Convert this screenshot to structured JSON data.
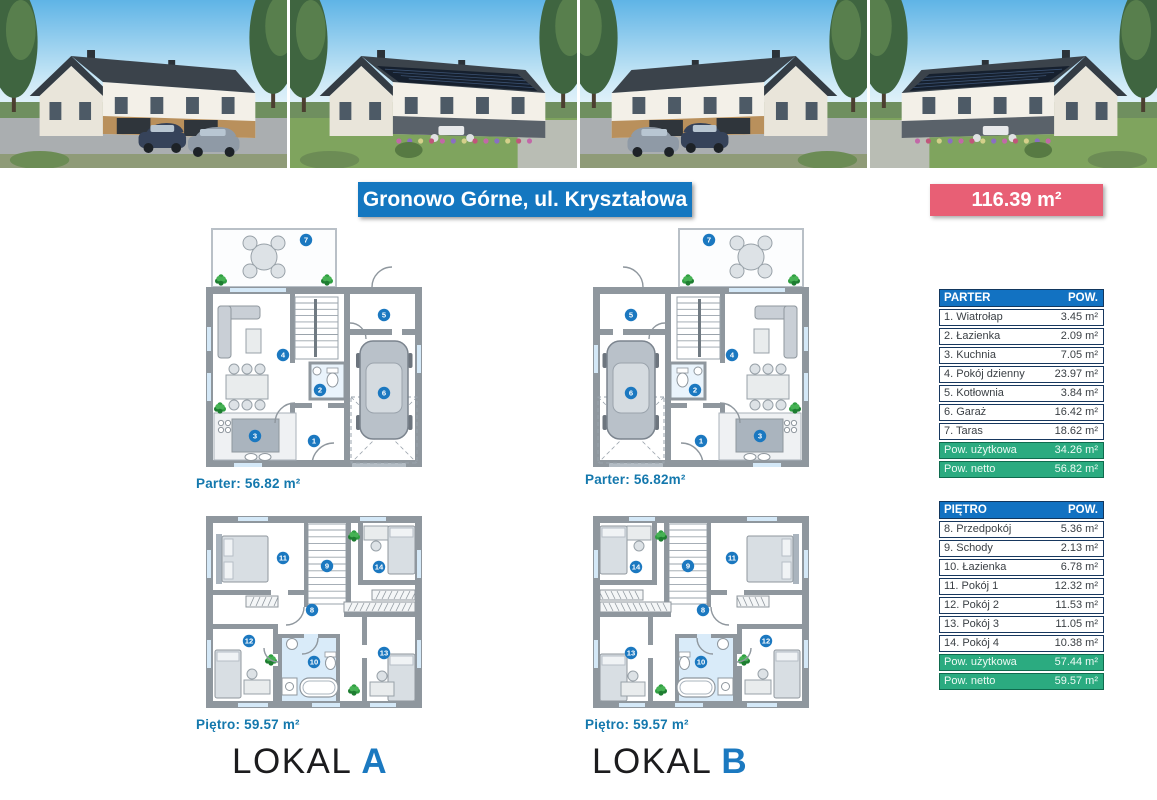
{
  "header": {
    "location_banner": "Gronowo Górne, ul. Kryształowa",
    "total_area": "116.39 m²"
  },
  "photos": [
    {
      "name": "street-view-photo-1"
    },
    {
      "name": "garden-view-photo-1"
    },
    {
      "name": "street-view-photo-2"
    },
    {
      "name": "garden-view-photo-2"
    }
  ],
  "units": [
    {
      "lokal_word": "LOKAL",
      "letter": "A",
      "parter_area_label": "Parter: 56.82 m²",
      "pietro_area_label": "Piętro: 59.57 m²"
    },
    {
      "lokal_word": "LOKAL",
      "letter": "B",
      "parter_area_label": "Parter: 56.82m²",
      "pietro_area_label": "Piętro: 59.57 m²"
    }
  ],
  "plans": {
    "parter_rooms": [
      "1",
      "2",
      "3",
      "4",
      "5",
      "6",
      "7"
    ],
    "pietro_rooms": [
      "8",
      "9",
      "10",
      "11",
      "12",
      "13",
      "14"
    ]
  },
  "tables": [
    {
      "title": "PARTER",
      "area_col": "POW.",
      "rows": [
        [
          "1. Wiatrołap",
          "3.45 m²"
        ],
        [
          "2. Łazienka",
          "2.09 m²"
        ],
        [
          "3. Kuchnia",
          "7.05 m²"
        ],
        [
          "4. Pokój dzienny",
          "23.97 m²"
        ],
        [
          "5. Kotłownia",
          "3.84 m²"
        ],
        [
          "6. Garaż",
          "16.42 m²"
        ],
        [
          "7. Taras",
          "18.62 m²"
        ]
      ],
      "totals": [
        [
          "Pow. użytkowa",
          "34.26 m²"
        ],
        [
          "Pow. netto",
          "56.82 m²"
        ]
      ]
    },
    {
      "title": "PIĘTRO",
      "area_col": "POW.",
      "rows": [
        [
          "8. Przedpokój",
          "5.36 m²"
        ],
        [
          "9. Schody",
          "2.13 m²"
        ],
        [
          "10. Łazienka",
          "6.78 m²"
        ],
        [
          "11. Pokój 1",
          "12.32 m²"
        ],
        [
          "12. Pokój 2",
          "11.53 m²"
        ],
        [
          "13. Pokój 3",
          "11.05 m²"
        ],
        [
          "14. Pokój 4",
          "10.38 m²"
        ]
      ],
      "totals": [
        [
          "Pow. użytkowa",
          "57.44 m²"
        ],
        [
          "Pow. netto",
          "59.57 m²"
        ]
      ]
    }
  ],
  "colors": {
    "banner_blue": "#1477c0",
    "badge_pink": "#e85f75",
    "table_header_blue": "#1272c2",
    "total_green": "#2bab80",
    "plan_badge_blue": "#1b78c0",
    "label_teal": "#1478ad",
    "lokal_letter_blue": "#1b79c0"
  }
}
